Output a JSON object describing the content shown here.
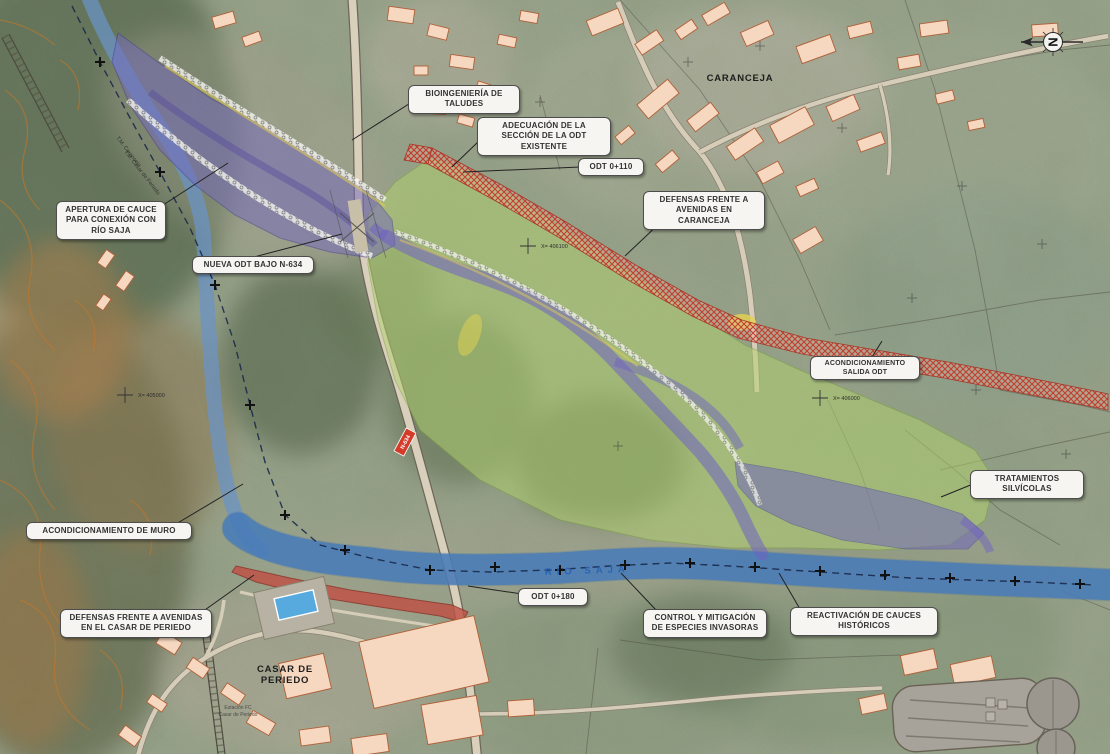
{
  "map": {
    "towns": {
      "caranceja": "CARANCEJA",
      "casar_line1": "CASAR DE",
      "casar_line2": "PERIEDO"
    },
    "river_label": "RÍO SAJA",
    "station": {
      "line1": "Estación FC",
      "line2": "Casar de Periedo"
    },
    "boundary": {
      "line1": "T.M. Caranceja",
      "line2": "T.M. Casar de Periedo"
    },
    "grid": {
      "x1": "X= 405000",
      "x2": "X= 406100",
      "x3": "X= 406000"
    },
    "road_shield": "N-634",
    "north": "N",
    "callouts": [
      {
        "id": "bioingenieria-taludes",
        "text": "BIOINGENIERÍA DE TALUDES"
      },
      {
        "id": "adecuacion-seccion-odt",
        "text": "ADECUACIÓN DE LA SECCIÓN DE LA ODT EXISTENTE"
      },
      {
        "id": "odt-0-110",
        "text": "ODT 0+110"
      },
      {
        "id": "defensas-caranceja",
        "text": "DEFENSAS FRENTE A AVENIDAS EN CARANCEJA"
      },
      {
        "id": "apertura-cauce",
        "text": "APERTURA DE CAUCE PARA CONEXIÓN CON RÍO SAJA"
      },
      {
        "id": "nueva-odt-n634",
        "text": "NUEVA ODT BAJO N-634"
      },
      {
        "id": "acondicionamiento-salida-odt",
        "text": "ACONDICIONAMIENTO SALIDA ODT"
      },
      {
        "id": "tratamientos-silvicolas",
        "text": "TRATAMIENTOS SILVÍCOLAS"
      },
      {
        "id": "acondicionamiento-muro",
        "text": "ACONDICIONAMIENTO DE MURO"
      },
      {
        "id": "defensas-casar-periedo",
        "text": "DEFENSAS FRENTE A AVENIDAS EN EL CASAR DE PERIEDO"
      },
      {
        "id": "odt-0-180",
        "text": "ODT 0+180"
      },
      {
        "id": "control-especies-invasoras",
        "text": "CONTROL Y MITIGACIÓN DE ESPECIES INVASORAS"
      },
      {
        "id": "reactivacion-cauces",
        "text": "REACTIVACIÓN DE CAUCES HISTÓRICOS"
      }
    ],
    "colors": {
      "flood_purple": "#7468bf",
      "works_green": "#aed06e",
      "river_blue": "#4f83be",
      "defense_red": "#c0392b",
      "building_fill": "#f6d7c0",
      "building_stroke": "#b06038",
      "callout_bg": "#f6f5f1",
      "callout_border": "#4d4d4d"
    }
  }
}
